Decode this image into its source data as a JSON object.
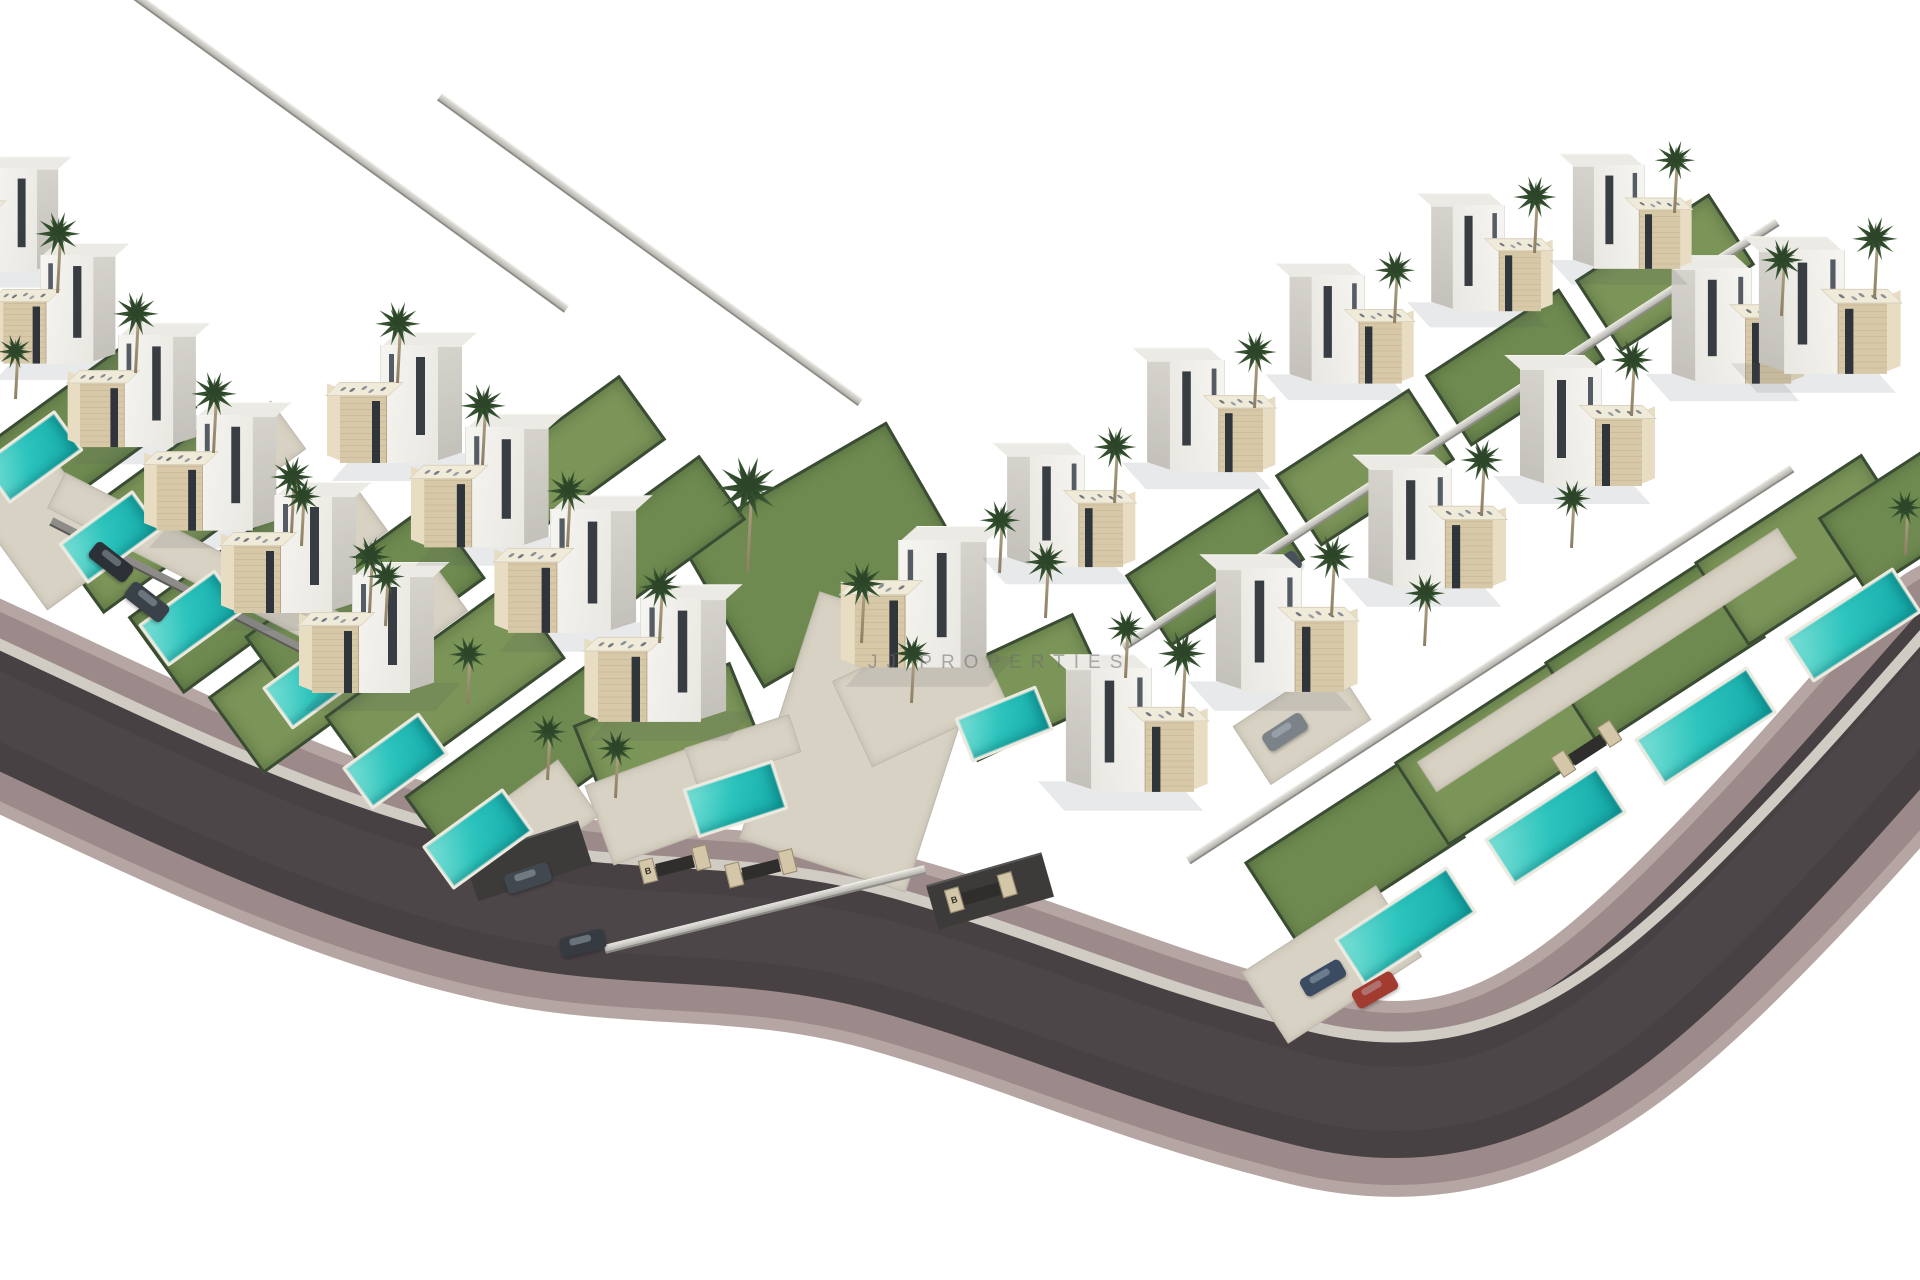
{
  "watermark": {
    "text": "JJ PROPERTIES"
  },
  "palette": {
    "background": "#ffffff",
    "asphalt": "#484144",
    "sidewalk": "#9c8a8b",
    "sidewalk_rim": "#b5a5a3",
    "curb": "#d0ccc4",
    "lawn": "#6f8a50",
    "lawn_alt": "#7b9458",
    "hedge": "#3a4c33",
    "pool_water": "#2cc4bd",
    "pool_rim": "#ece9df",
    "patio": "#d8d2c4",
    "house_white": "#f5f4f0",
    "house_shade": "#cfcdc6",
    "stone": "#d7c8a8",
    "window_dark": "#383d44",
    "palm_green": "#41603a",
    "palm_trunk": "#9c8e71",
    "car_red": "#a23b30",
    "watermark_gray": "#6e6e6e"
  },
  "scene": {
    "road": {
      "center": "M -40 688 C 150 775 330 870 520 908 C 650 933 760 915 905 958 C 1050 1000 1140 1045 1310 1088 C 1470 1128 1580 1055 1700 938 C 1800 840 1880 745 1960 655",
      "curb": "M -40 626 C 150 713 330 808 520 846 C 650 871 760 853 905 896 C 1050 938 1140 983 1310 1026 C 1470 1066 1580 993 1700 876 C 1800 778 1880 683 1960 593"
    },
    "lawns": [
      [
        -25,
        385,
        215,
        95,
        -36
      ],
      [
        55,
        465,
        215,
        95,
        -36
      ],
      [
        135,
        545,
        215,
        95,
        -36
      ],
      [
        215,
        625,
        215,
        95,
        -36
      ],
      [
        250,
        560,
        230,
        95,
        -36
      ],
      [
        330,
        640,
        230,
        95,
        -36
      ],
      [
        410,
        720,
        230,
        95,
        -36
      ],
      [
        585,
        690,
        170,
        100,
        -22
      ],
      [
        705,
        470,
        240,
        170,
        -30
      ],
      [
        950,
        640,
        150,
        95,
        -25
      ],
      [
        1255,
        800,
        200,
        100,
        -33
      ],
      [
        1405,
        700,
        200,
        100,
        -33
      ],
      [
        1555,
        600,
        200,
        100,
        -33
      ],
      [
        1705,
        500,
        200,
        100,
        -33
      ],
      [
        1135,
        525,
        160,
        85,
        -33
      ],
      [
        1285,
        425,
        160,
        85,
        -33
      ],
      [
        1435,
        325,
        160,
        85,
        -33
      ],
      [
        1585,
        230,
        160,
        85,
        -33
      ],
      [
        1830,
        470,
        150,
        90,
        -33
      ],
      [
        480,
        420,
        180,
        80,
        -36
      ],
      [
        560,
        500,
        180,
        80,
        -36
      ]
    ],
    "patios": [
      [
        775,
        612,
        175,
        260,
        18
      ],
      [
        595,
        760,
        135,
        85,
        -20
      ],
      [
        0,
        465,
        95,
        130,
        -36
      ],
      [
        1252,
        922,
        160,
        85,
        -33
      ],
      [
        845,
        645,
        150,
        95,
        -25
      ],
      [
        1392,
        642,
        430,
        36,
        -33
      ],
      [
        38,
        545,
        330,
        40,
        27
      ],
      [
        470,
        788,
        120,
        70,
        -36
      ],
      [
        180,
        430,
        120,
        60,
        -36
      ],
      [
        262,
        512,
        120,
        60,
        -36
      ],
      [
        342,
        592,
        120,
        60,
        -36
      ],
      [
        688,
        730,
        110,
        40,
        -18
      ],
      [
        1242,
        688,
        120,
        70,
        -33
      ]
    ],
    "pools": [
      [
        -14,
        432,
        92,
        50,
        -36
      ],
      [
        64,
        512,
        92,
        50,
        -36
      ],
      [
        144,
        592,
        95,
        52,
        -36
      ],
      [
        268,
        655,
        95,
        52,
        -36
      ],
      [
        348,
        735,
        95,
        52,
        -36
      ],
      [
        428,
        812,
        100,
        54,
        -36
      ],
      [
        688,
        773,
        95,
        52,
        -18
      ],
      [
        960,
        700,
        88,
        48,
        -22
      ],
      [
        1338,
        898,
        135,
        56,
        -33
      ],
      [
        1488,
        798,
        135,
        56,
        -33
      ],
      [
        1638,
        698,
        135,
        56,
        -33
      ],
      [
        1788,
        598,
        130,
        54,
        -33
      ]
    ],
    "villas": [
      [
        -14,
        168,
        0.88,
        0
      ],
      [
        40,
        255,
        0.92,
        0
      ],
      [
        118,
        335,
        0.95,
        0
      ],
      [
        196,
        415,
        0.98,
        0
      ],
      [
        274,
        495,
        1.0,
        0
      ],
      [
        352,
        575,
        1.0,
        0
      ],
      [
        380,
        345,
        1.0,
        0
      ],
      [
        465,
        427,
        1.02,
        0
      ],
      [
        550,
        509,
        1.05,
        0
      ],
      [
        640,
        598,
        1.05,
        0
      ],
      [
        898,
        540,
        1.08,
        0
      ],
      [
        1152,
        668,
        1.05,
        1
      ],
      [
        1302,
        568,
        1.05,
        1
      ],
      [
        1452,
        468,
        1.02,
        1
      ],
      [
        1602,
        368,
        1.0,
        1
      ],
      [
        1752,
        268,
        0.98,
        1
      ],
      [
        1085,
        455,
        0.95,
        1
      ],
      [
        1225,
        360,
        0.95,
        1
      ],
      [
        1365,
        275,
        0.92,
        1
      ],
      [
        1505,
        205,
        0.9,
        1
      ],
      [
        1645,
        165,
        0.88,
        1
      ],
      [
        1845,
        250,
        1.05,
        1
      ]
    ],
    "walls": [
      [
        60,
        140,
        560,
        36,
        "light"
      ],
      [
        390,
        245,
        520,
        36,
        "light"
      ],
      [
        1060,
        430,
        780,
        -33,
        "light"
      ],
      [
        1130,
        660,
        720,
        -33,
        "light"
      ],
      [
        35,
        585,
        300,
        27,
        "dark"
      ],
      [
        600,
        905,
        330,
        -14,
        "light"
      ],
      [
        468,
        838,
        120,
        -18,
        "block"
      ],
      [
        930,
        868,
        120,
        -16,
        "block"
      ]
    ],
    "gates": [
      [
        640,
        852,
        "B",
        -14
      ],
      [
        726,
        856,
        "",
        -14
      ],
      [
        946,
        880,
        "B",
        -16
      ],
      [
        1552,
        736,
        "",
        -33
      ]
    ],
    "cars": [
      [
        88,
        552,
        38,
        "#2c3137"
      ],
      [
        124,
        592,
        38,
        "#3a4149"
      ],
      [
        505,
        868,
        -18,
        "#42484f"
      ],
      [
        560,
        933,
        -14,
        "#363b42"
      ],
      [
        1256,
        560,
        -33,
        "#49505a"
      ],
      [
        1262,
        722,
        -33,
        "#7b8288"
      ],
      [
        1300,
        968,
        -30,
        "#3b4b61"
      ],
      [
        1352,
        980,
        -30,
        "#a23b30"
      ]
    ],
    "palms": [
      [
        58,
        295,
        0.95
      ],
      [
        136,
        375,
        0.95
      ],
      [
        214,
        455,
        0.95
      ],
      [
        292,
        535,
        0.9
      ],
      [
        370,
        615,
        0.9
      ],
      [
        398,
        385,
        0.95
      ],
      [
        483,
        467,
        0.95
      ],
      [
        568,
        549,
        0.9
      ],
      [
        302,
        548,
        0.8
      ],
      [
        386,
        628,
        0.8
      ],
      [
        468,
        706,
        0.8
      ],
      [
        548,
        782,
        0.78
      ],
      [
        15,
        400,
        0.75
      ],
      [
        748,
        575,
        1.35
      ],
      [
        660,
        645,
        0.9
      ],
      [
        862,
        645,
        0.95
      ],
      [
        912,
        705,
        0.8
      ],
      [
        616,
        800,
        0.8
      ],
      [
        1000,
        575,
        0.85
      ],
      [
        1046,
        620,
        0.9
      ],
      [
        1126,
        680,
        0.8
      ],
      [
        1182,
        718,
        1.0
      ],
      [
        1332,
        618,
        0.95
      ],
      [
        1482,
        518,
        0.9
      ],
      [
        1632,
        418,
        0.9
      ],
      [
        1782,
        318,
        0.9
      ],
      [
        1115,
        505,
        0.9
      ],
      [
        1255,
        410,
        0.9
      ],
      [
        1395,
        325,
        0.85
      ],
      [
        1535,
        255,
        0.9
      ],
      [
        1675,
        215,
        0.85
      ],
      [
        1875,
        300,
        0.95
      ],
      [
        1905,
        556,
        0.75
      ],
      [
        1425,
        648,
        0.85
      ],
      [
        1572,
        550,
        0.8
      ]
    ]
  }
}
